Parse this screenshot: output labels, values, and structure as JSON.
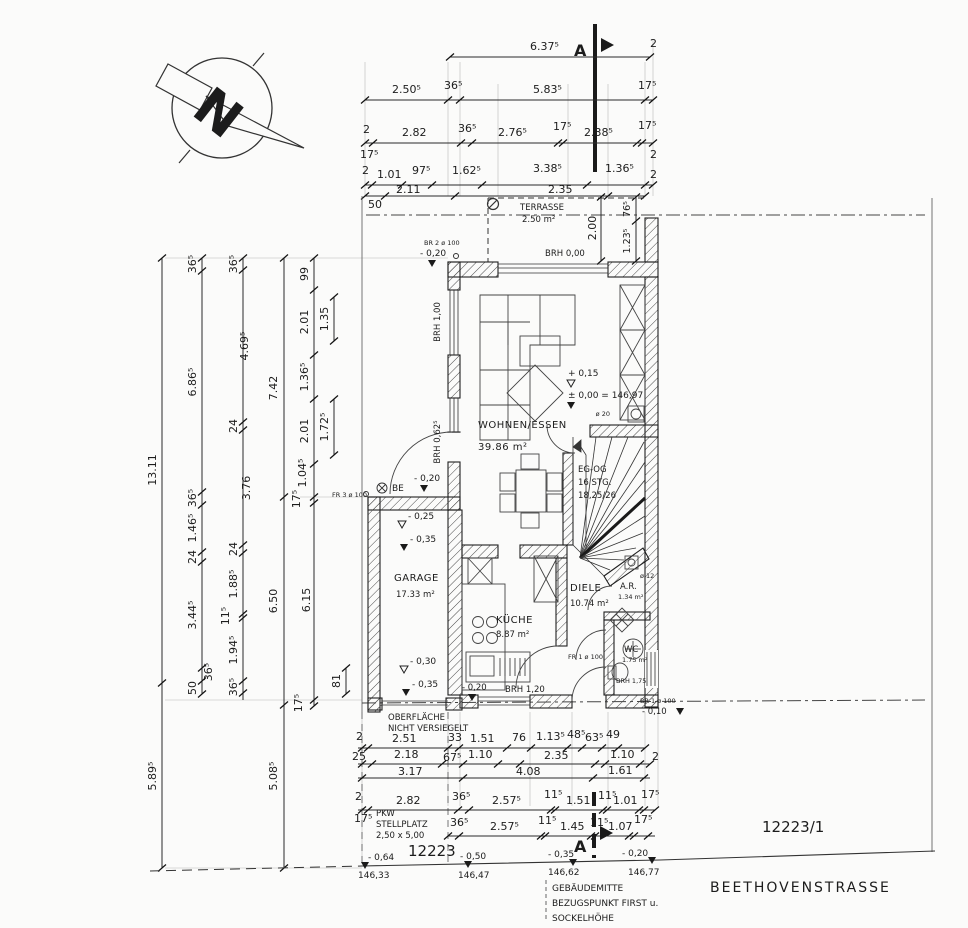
{
  "north": {
    "letter": "N"
  },
  "section": {
    "letter": "A"
  },
  "top": {
    "r1": [
      "6.37⁵",
      "2"
    ],
    "r2": [
      "2.50⁵",
      "36⁵",
      "5.83⁵",
      "17⁵"
    ],
    "r3": [
      "2",
      "17⁵",
      "2.82",
      "36⁵",
      "2.76⁵",
      "17⁵",
      "2.38⁵",
      "17⁵",
      "2"
    ],
    "r4": [
      "2",
      "1.01",
      "97⁵",
      "1.62⁵",
      "3.38⁵",
      "1.36⁵",
      "2"
    ],
    "r5": [
      "50",
      "2.11",
      "2.35"
    ]
  },
  "left": {
    "a": [
      "13.11",
      "5.89⁵"
    ],
    "b": [
      "36⁵",
      "6.86⁵",
      "36⁵",
      "1.46⁵",
      "24",
      "3.44⁵",
      "36⁵",
      "50"
    ],
    "c": [
      "36⁵",
      "4.69⁵",
      "24",
      "3.76",
      "24",
      "1.88⁵",
      "11⁵",
      "1.94⁵",
      "36⁵"
    ],
    "d": [
      "7.42",
      "6.50",
      "5.08⁵"
    ],
    "e": [
      "99",
      "2.01",
      "1.36⁵",
      "2.01",
      "1.04⁵",
      "17⁵",
      "6.15",
      "17⁵"
    ],
    "f": [
      "1.35",
      "1.72⁵",
      "81"
    ]
  },
  "bottom": {
    "a": [
      "2",
      "2.51",
      "33",
      "1.51",
      "76",
      "1.13⁵",
      "48⁵",
      "63⁵",
      "49"
    ],
    "b": [
      "25",
      "2.18",
      "67⁵",
      "1.10",
      "2.35",
      "1.10",
      "2"
    ],
    "b2": [
      "3.17",
      "4.08",
      "1.61"
    ],
    "c": [
      "2",
      "2.82",
      "36⁵",
      "2.57⁵",
      "11⁵",
      "1.51",
      "11⁵",
      "1.01",
      "17⁵"
    ],
    "d": [
      "17⁵",
      "36⁵",
      "2.57⁵",
      "11⁵",
      "1.45",
      "11⁵",
      "1.07",
      "17⁵"
    ]
  },
  "terrace": {
    "name": "TERRASSE",
    "area": "2.50 m²",
    "brh": "BRH 0,00",
    "h": "2.00",
    "s1": "76⁵",
    "s2": "1.23⁵"
  },
  "rooms": {
    "living": {
      "name": "WOHNEN/ESSEN",
      "area": "39.86 m²"
    },
    "kitchen": {
      "name": "KÜCHE",
      "area": "8.87 m²"
    },
    "diele": {
      "name": "DIELE",
      "area": "10.74 m²"
    },
    "ar": {
      "name": "A.R.",
      "area": "1.34 m²"
    },
    "wc": {
      "name": "WC",
      "area": "1.75 m²"
    },
    "garage": {
      "name": "GARAGE",
      "area": "17.33 m²"
    },
    "stairs": {
      "l1": "EG-OG",
      "l2": "16 STG.",
      "l3": "18,25/26"
    }
  },
  "levels": {
    "p015": "+ 0,15",
    "p000": "± 0,00 = 146,97",
    "m010": "- 0,10",
    "m020": "- 0,20",
    "m025": "- 0,25",
    "m030": "- 0,30",
    "m035": "- 0,35",
    "brh100": "BRH 1,00",
    "brh0625": "BRH 0,62⁵",
    "brh120": "BRH 1,20",
    "brh175": "BRH 1,75",
    "be": "BE"
  },
  "openings": {
    "br2": "BR 2 ø 100",
    "fr3": "FR 3 ø 100",
    "fr1": "FR 1 ø 100",
    "br1": "BR 1 ø 100",
    "d20": "ø 20",
    "d12": "ø 12"
  },
  "site": {
    "surface1": "OBERFLÄCHE",
    "surface2": "NICHT VERSIEGELT",
    "pkw1": "PKW",
    "pkw2": "STELLPLATZ",
    "pkw3": "2,50 x 5,00",
    "parcel": "12223",
    "parcel2": "12223/1",
    "street": "BEETHOVENSTRASSE",
    "note1": "GEBÄUDEMITTE",
    "note2": "BEZUGSPUNKT FIRST u.",
    "note3": "SOCKELHÖHE",
    "elev": [
      {
        "rel": "- 0,64",
        "abs": "146,33"
      },
      {
        "rel": "- 0,50",
        "abs": "146,47"
      },
      {
        "rel": "- 0,35",
        "abs": "146,62"
      },
      {
        "rel": "- 0,20",
        "abs": "146,77"
      }
    ]
  }
}
